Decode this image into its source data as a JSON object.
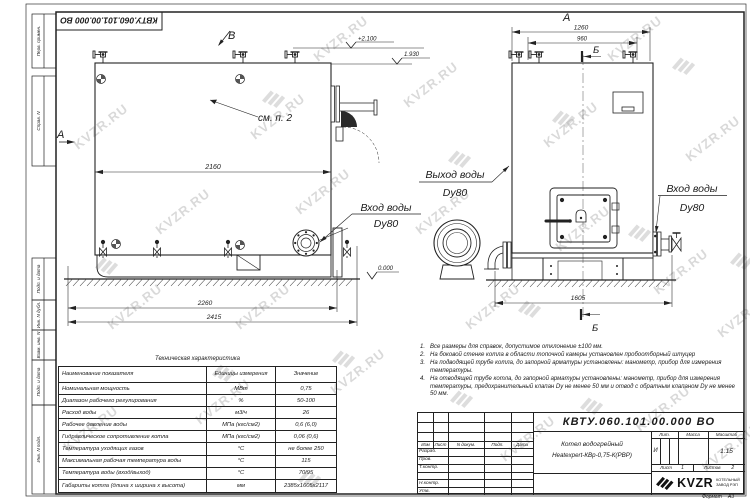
{
  "doc_code": "КВТУ.060.101.00.000 ВО",
  "watermark": {
    "text": "KVZR.RU"
  },
  "margins": [
    "Перв. примен.",
    "Справ. N",
    "Подп. и дата",
    "Инв. N дубл.",
    "Взам. инв. N",
    "Подп. и дата",
    "Инв. N подл."
  ],
  "views": {
    "marker_a_side": "А",
    "marker_a_top": "А",
    "marker_v": "В",
    "marker_b": "Б",
    "see_note": "см. п. 2",
    "elev_top": "+2.100",
    "elev_pipe": "1.930",
    "elev_zero": "0.000",
    "inlet_line1": "Вход воды",
    "inlet_line2": "Dy80",
    "outlet_line1": "Выход воды",
    "outlet_line2": "Dy80",
    "inlet2_line1": "Вход воды",
    "inlet2_line2": "Dy80",
    "dims": {
      "d2160": "2160",
      "d2260": "2260",
      "d2415": "2415",
      "d1260": "1260",
      "d960": "960",
      "d1605": "1605"
    }
  },
  "table": {
    "title": "Техническая характеристика",
    "col_name": "Наименование показателя",
    "col_units": "Единицы измерения",
    "col_value": "Значение",
    "rows": [
      {
        "name": "Номинальная мощность",
        "unit": "МВт",
        "value": "0,75"
      },
      {
        "name": "Диапазон рабочего регулирования",
        "unit": "%",
        "value": "50-100"
      },
      {
        "name": "Расход воды",
        "unit": "м3/ч",
        "value": "26"
      },
      {
        "name": "Рабочее давление воды",
        "unit": "МПа (кгс/см2)",
        "value": "0,6 (6,0)"
      },
      {
        "name": "Гидравлическое сопротивление котла",
        "unit": "МПа (кгс/см2)",
        "value": "0,06 (0,6)"
      },
      {
        "name": "Температура уходящих газов",
        "unit": "°С",
        "value": "не более 250"
      },
      {
        "name": "Максимальная рабочая температура воды",
        "unit": "°С",
        "value": "115"
      },
      {
        "name": "Температура воды (вход/выход)",
        "unit": "°С",
        "value": "70/95"
      },
      {
        "name": "Габариты котла (длина х ширина х высота)",
        "unit": "мм",
        "value": "2385х1605х2117"
      }
    ]
  },
  "notes": {
    "items": [
      {
        "num": "1.",
        "text": "Все размеры для справок, допустимое отклонение ±100 мм."
      },
      {
        "num": "2.",
        "text": "На боковой стенке котла в области топочной камеры установлен пробоотборный штуцер"
      },
      {
        "num": "3.",
        "text": "На подводящей трубе котла, до запорной арматуры установлены: манометр, прибор для измерения температуры."
      },
      {
        "num": "4.",
        "text": "На отводящей трубе котла, до запорной арматуры установлены: манометр, прибор для измерения температуры, предохранительный клапан Dу не менее 50 мм и отвод с обратным клапаном Dу не менее 50 мм."
      }
    ]
  },
  "stamp": {
    "code": "КВТУ.060.101.00.000 ВО",
    "title_line1": "Котел водогрейный",
    "title_line2": "Heatexpert-КВр-0,75-К(РВР)",
    "header_izm": "Изм",
    "header_list": "Лист",
    "header_doc": "N докум.",
    "header_sign": "Подп.",
    "header_date": "Дата",
    "rows": [
      "Разраб.",
      "Пров.",
      "Т.контр.",
      "",
      "Н.контр.",
      "Утв."
    ],
    "lit_header": "Лит.",
    "mass_header": "Масса",
    "scale_header": "Масштаб",
    "lit_value": "И",
    "scale_value": "1:15",
    "sheet_label": "Лист",
    "sheet_value": "1",
    "sheets_label": "Листов",
    "sheets_value": "2",
    "logo_text": "KVZR",
    "logo_caption_line1": "КОТЕЛЬНЫЙ",
    "logo_caption_line2": "ЗАВОД РЭП",
    "format_label": "Формат",
    "format_value": "А3"
  }
}
